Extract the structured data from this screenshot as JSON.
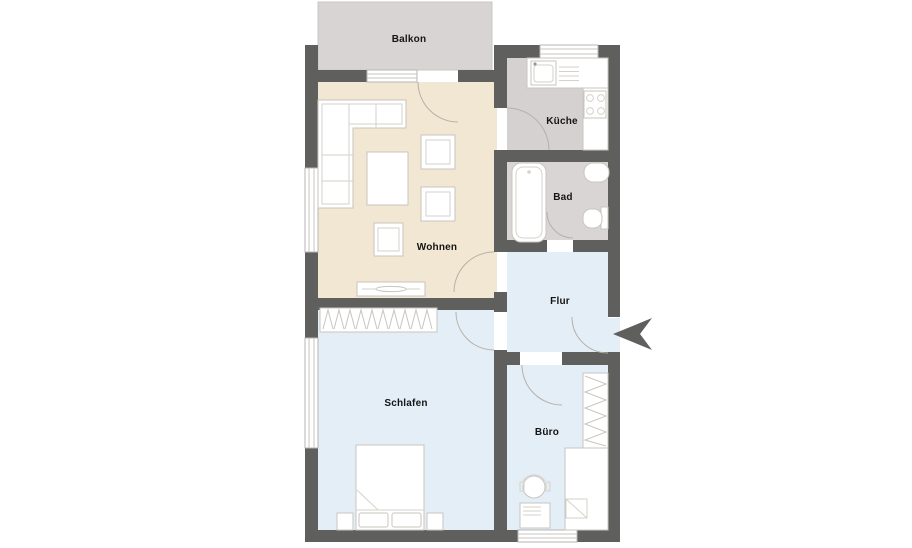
{
  "plan": {
    "type": "apartment-floor-plan",
    "rooms": [
      {
        "id": "balkon",
        "label": "Balkon",
        "floor_color": "#d7d4d3"
      },
      {
        "id": "kueche",
        "label": "Küche",
        "floor_color": "#d4d1d0"
      },
      {
        "id": "bad",
        "label": "Bad",
        "floor_color": "#d8d5d4"
      },
      {
        "id": "wohnen",
        "label": "Wohnen",
        "floor_color": "#f1e7d2"
      },
      {
        "id": "flur",
        "label": "Flur",
        "floor_color": "#e3eef7"
      },
      {
        "id": "schlafen",
        "label": "Schlafen",
        "floor_color": "#e3eef7"
      },
      {
        "id": "buero",
        "label": "Büro",
        "floor_color": "#e3eef7"
      }
    ],
    "colors": {
      "wall": "#5f5f5d",
      "background": "#ffffff",
      "furniture_fill": "#ffffff",
      "furniture_outline": "#c9c5bf",
      "door_swing": "#b6b0a7",
      "entrance_arrow": "#5f5f5d"
    },
    "icons": {
      "entrance_arrow": "arrow pointing left at apartment entry door"
    },
    "furniture": {
      "wohnen": [
        "corner-sofa",
        "coffee-table",
        "armchair",
        "armchair",
        "chair",
        "sideboard-with-tv"
      ],
      "kueche": [
        "countertop",
        "kitchen-sink",
        "dish-drainer",
        "stove-four-burners"
      ],
      "bad": [
        "bathtub",
        "washbasin",
        "toilet"
      ],
      "flur": [],
      "schlafen": [
        "wardrobe-with-hangers",
        "double-bed",
        "nightstand",
        "nightstand"
      ],
      "buero": [
        "bookshelf",
        "closet",
        "desk",
        "office-chair"
      ]
    }
  }
}
